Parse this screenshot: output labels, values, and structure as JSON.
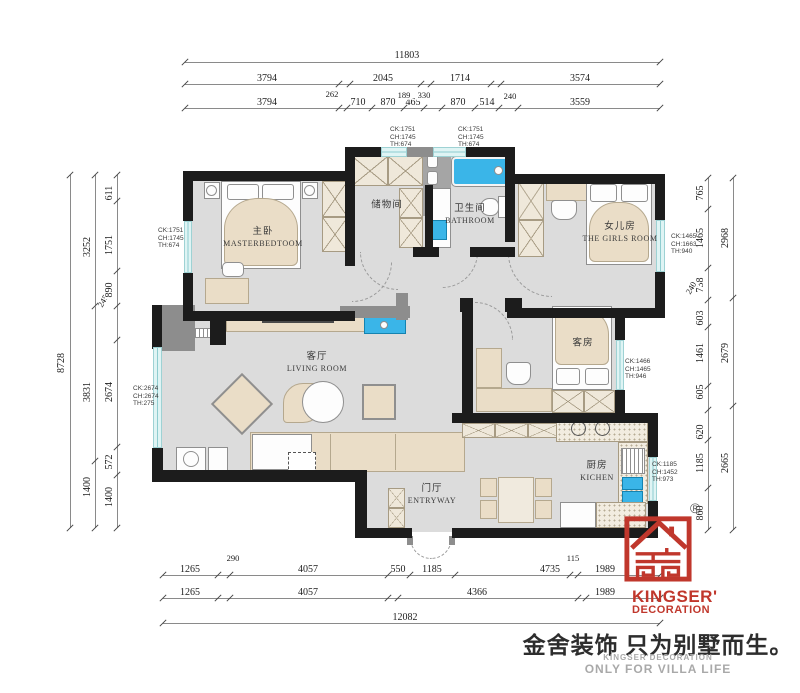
{
  "rooms": {
    "master": {
      "cn": "主卧",
      "en": "MASTERBEDTOOM"
    },
    "storage": {
      "cn": "储物间"
    },
    "bathroom": {
      "cn": "卫生间",
      "en": "BATHROOM"
    },
    "girls": {
      "cn": "女儿房",
      "en": "THE GIRLS ROOM"
    },
    "living": {
      "cn": "客厅",
      "en": "LIVING ROOM"
    },
    "guest": {
      "cn": "客房"
    },
    "kitchen": {
      "cn": "厨房",
      "en": "KICHEN"
    },
    "entry": {
      "cn": "门厅",
      "en": "ENTRYWAY"
    }
  },
  "windows": {
    "master_left": [
      "CK:1751",
      "CH:1745",
      "TH:674"
    ],
    "living_left": [
      "CK:2674",
      "CH:2674",
      "TH:275"
    ],
    "top_storage": [
      "CK:1751",
      "CH:1745",
      "TH:674"
    ],
    "top_bath": [
      "CK:1751",
      "CH:1745",
      "TH:674"
    ],
    "girls_right": [
      "CK:1465",
      "CH:1663",
      "TH:940"
    ],
    "guest_right": [
      "CK:1466",
      "CH:1465",
      "TH:946"
    ],
    "kitchen_right": [
      "CK:1185",
      "CH:1452",
      "TH:973"
    ]
  },
  "dims": {
    "top_total": "11803",
    "top_row2": [
      "3794",
      "2045",
      "1714",
      "3574"
    ],
    "top_row2_small": "262",
    "top_row3": [
      "3794",
      "710",
      "870",
      "465",
      "870",
      "514",
      "3559"
    ],
    "top_row3_small": [
      "189",
      "330",
      "240"
    ],
    "left_outer": "8728",
    "left_mid": [
      "3252",
      "3831",
      "1400"
    ],
    "left_mid_small": "245",
    "left_inner": [
      "611",
      "1751",
      "890",
      "2674",
      "572",
      "1400"
    ],
    "right_inner": [
      "765",
      "1465",
      "738",
      "603",
      "1461",
      "605",
      "620",
      "1185",
      "860"
    ],
    "right_inner_small": "240",
    "right_outer": [
      "2968",
      "2679",
      "2665"
    ],
    "bottom_row1": [
      "1265",
      "4057",
      "550",
      "1185",
      "4735",
      "1989"
    ],
    "bottom_row1_small": [
      "290",
      "115"
    ],
    "bottom_row2": [
      "1265",
      "4057",
      "4366",
      "1989"
    ],
    "bottom_total": "12082"
  },
  "brand": {
    "registered": "®",
    "name_line1": "KINGSER'",
    "name_line2": "DECORATION",
    "slogan_cn": "金舍装饰 只为别墅而生。",
    "sub1": "KINGSER'DECORATION",
    "sub2": "ONLY FOR VILLA LIFE"
  },
  "colors": {
    "wall": "#1c1c1c",
    "gray_wall": "#8d8d8d",
    "floor": "#dcdcdc",
    "window": "#dff4f4",
    "fixture_blue": "#3ab5e8",
    "brand_red": "#c0372c",
    "furniture": "#eaddc7"
  }
}
